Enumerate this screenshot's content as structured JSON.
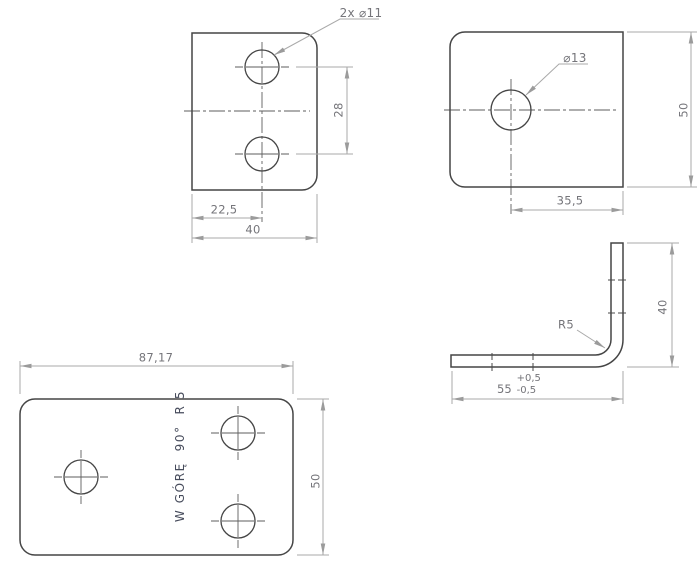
{
  "drawing": {
    "colors": {
      "background": "#ffffff",
      "geometry": "#454545",
      "centerline": "#5e5e5e",
      "dimension_line": "#a9a9a9",
      "dimension_text": "#75757a",
      "note_text": "#474c5c"
    },
    "views": {
      "flange_two_holes": {
        "hole_callout": "2x ⌀11",
        "hole_spacing": "28",
        "hole_offset": "22,5",
        "width": "40"
      },
      "flange_one_hole": {
        "hole_callout": "⌀13",
        "hole_offset": "35,5",
        "height": "50"
      },
      "side_profile": {
        "bend_radius": "R5",
        "height": "40",
        "length": "55",
        "tol_plus": "+0,5",
        "tol_minus": "-0,5"
      },
      "flat_pattern": {
        "width": "87,17",
        "height": "50",
        "bend_note": "W GÓRĘ  90°  R 5"
      }
    }
  }
}
